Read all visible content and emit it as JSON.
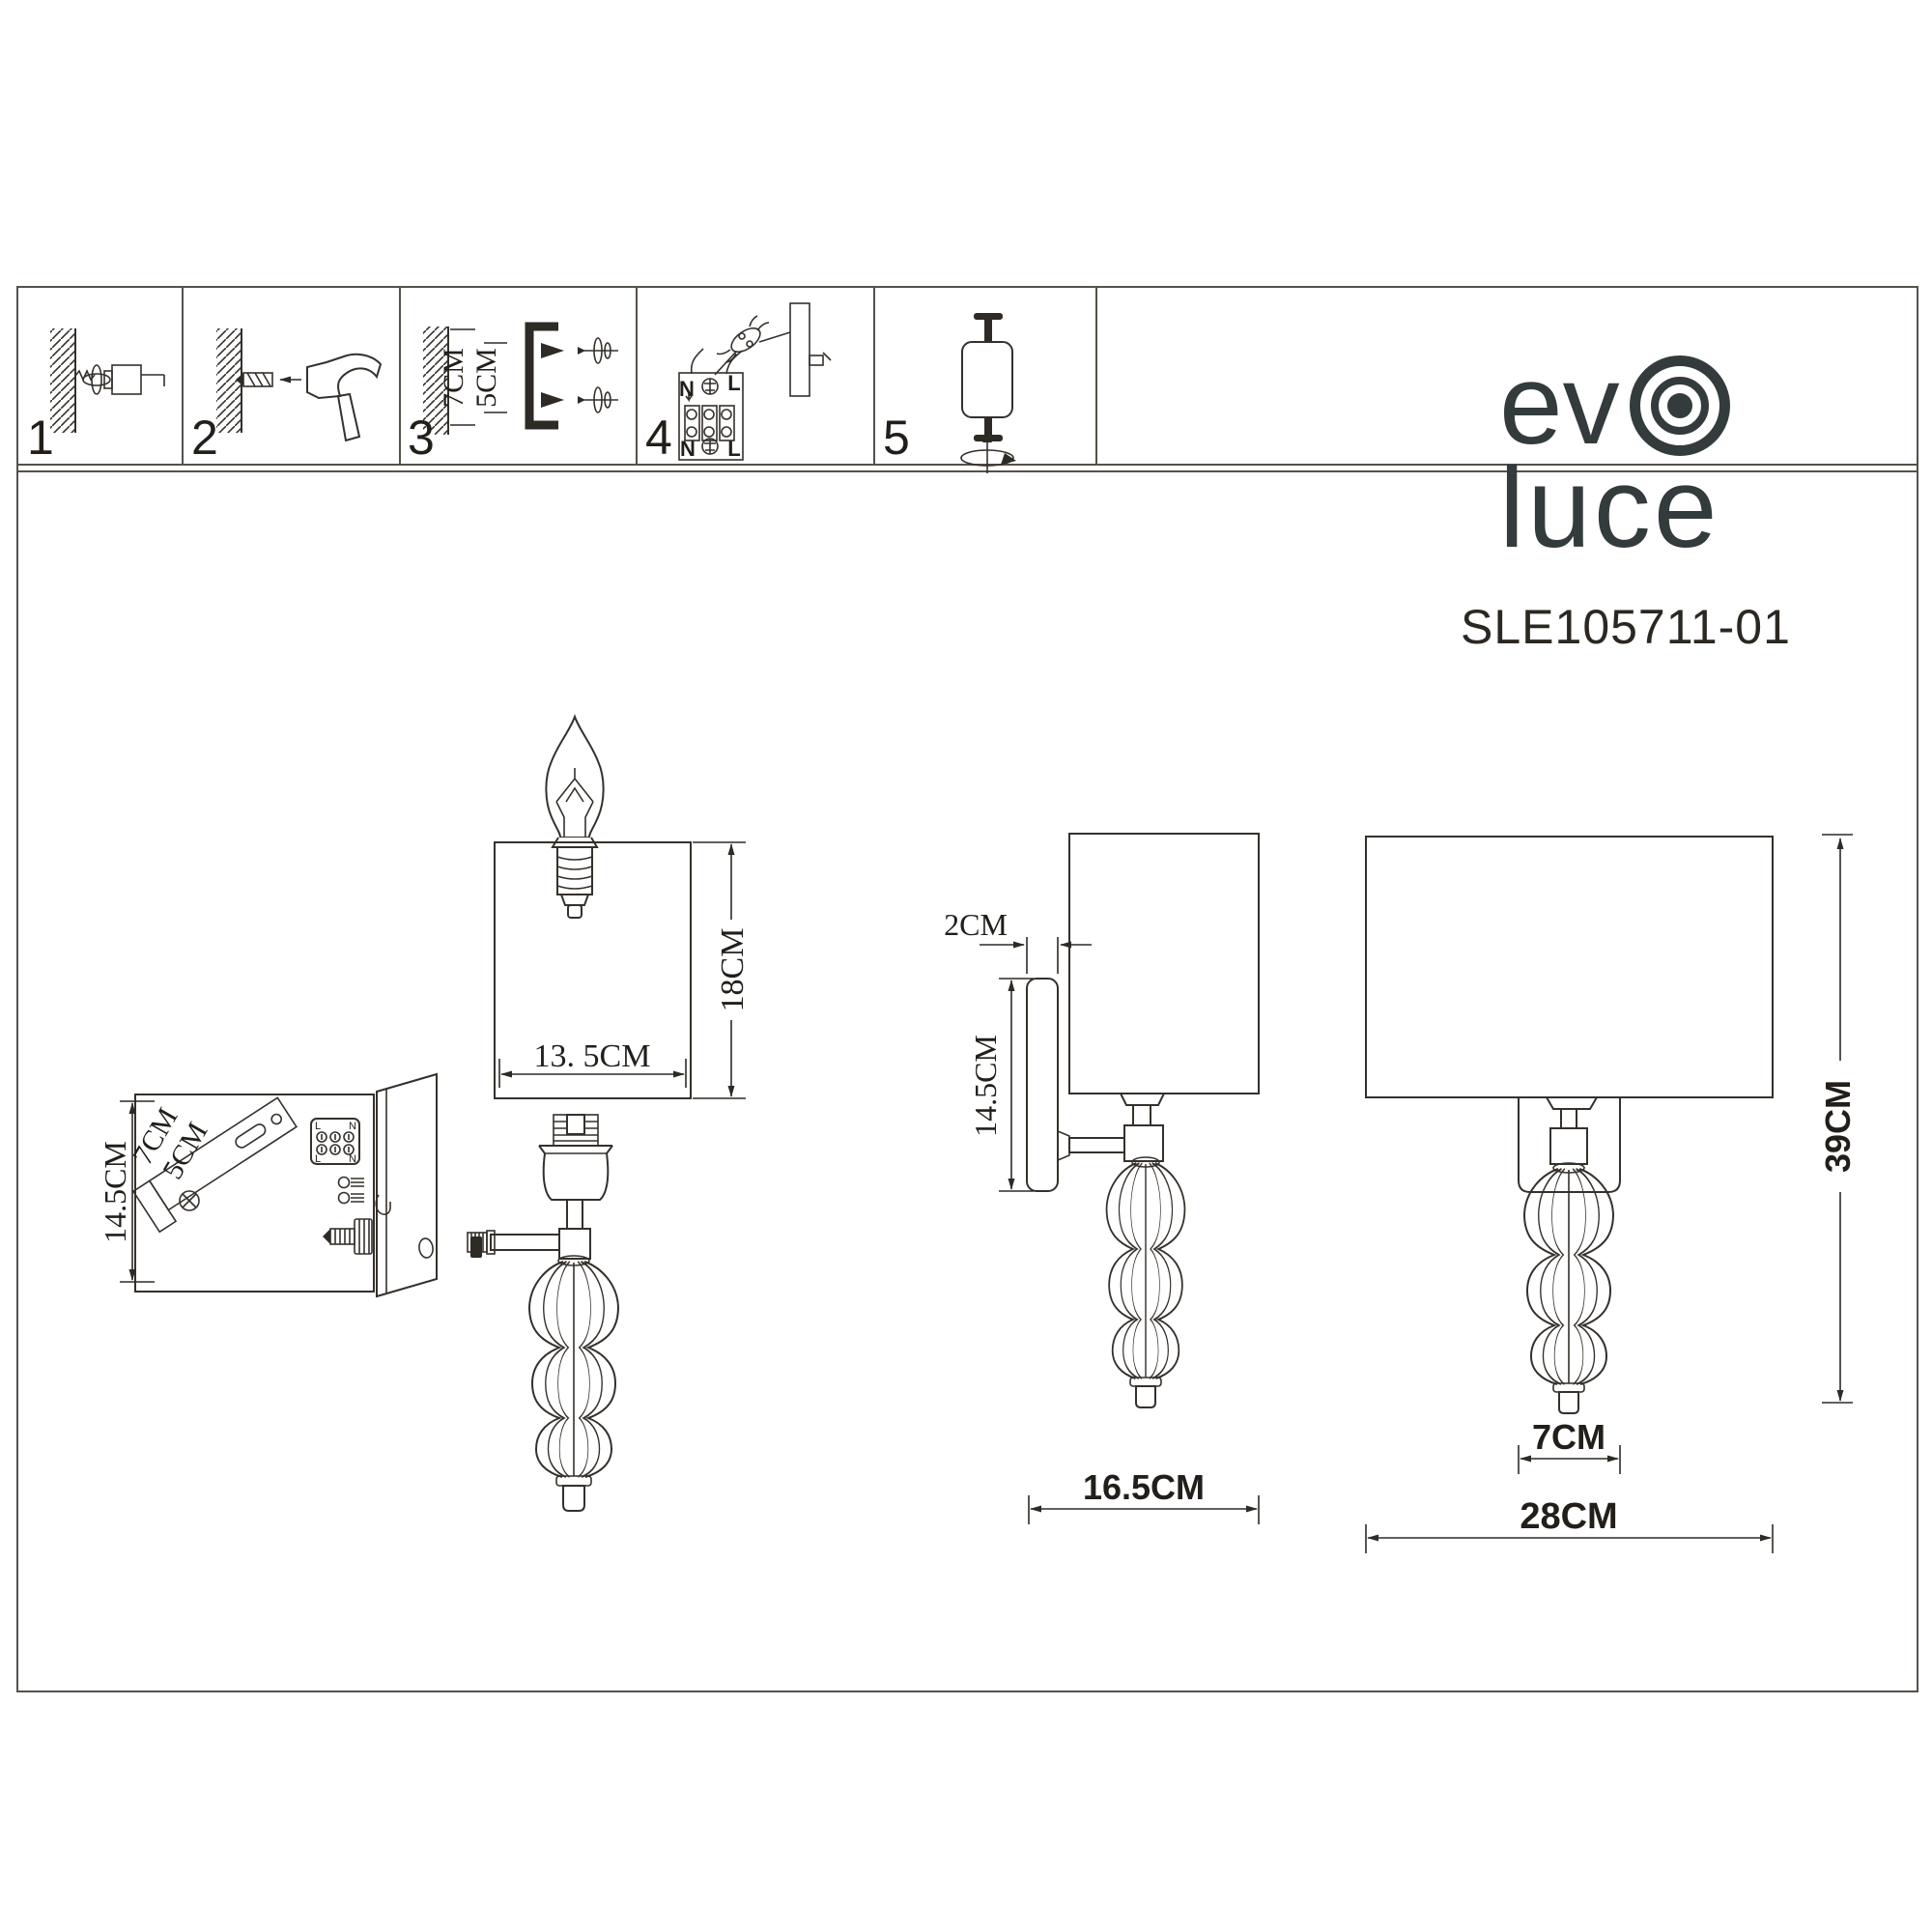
{
  "strip": {
    "steps": [
      {
        "num": "1"
      },
      {
        "num": "2"
      },
      {
        "num": "3",
        "dims": {
          "a": "7CM",
          "b": "5CM"
        }
      },
      {
        "num": "4",
        "terminals": {
          "top_left": "N",
          "top_right": "L",
          "bottom_left": "N",
          "bottom_right": "L"
        }
      },
      {
        "num": "5"
      }
    ]
  },
  "brand": {
    "word1": "ev",
    "word2": "luce",
    "model": "SLE105711-01",
    "color": "#343b3d"
  },
  "exploded": {
    "shade_width": "13. 5CM",
    "shade_height": "18CM"
  },
  "backplate": {
    "height": "14.5CM",
    "bracket_length": "7CM",
    "bracket_pitch": "5CM",
    "block": {
      "top_left": "L",
      "top_right": "N",
      "bottom_left": "L",
      "bottom_right": "N"
    }
  },
  "side": {
    "plate_thickness": "2CM",
    "plate_height": "14.5CM",
    "depth": "16.5CM"
  },
  "front": {
    "glass_width": "7CM",
    "width": "28CM",
    "height": "39CM"
  }
}
